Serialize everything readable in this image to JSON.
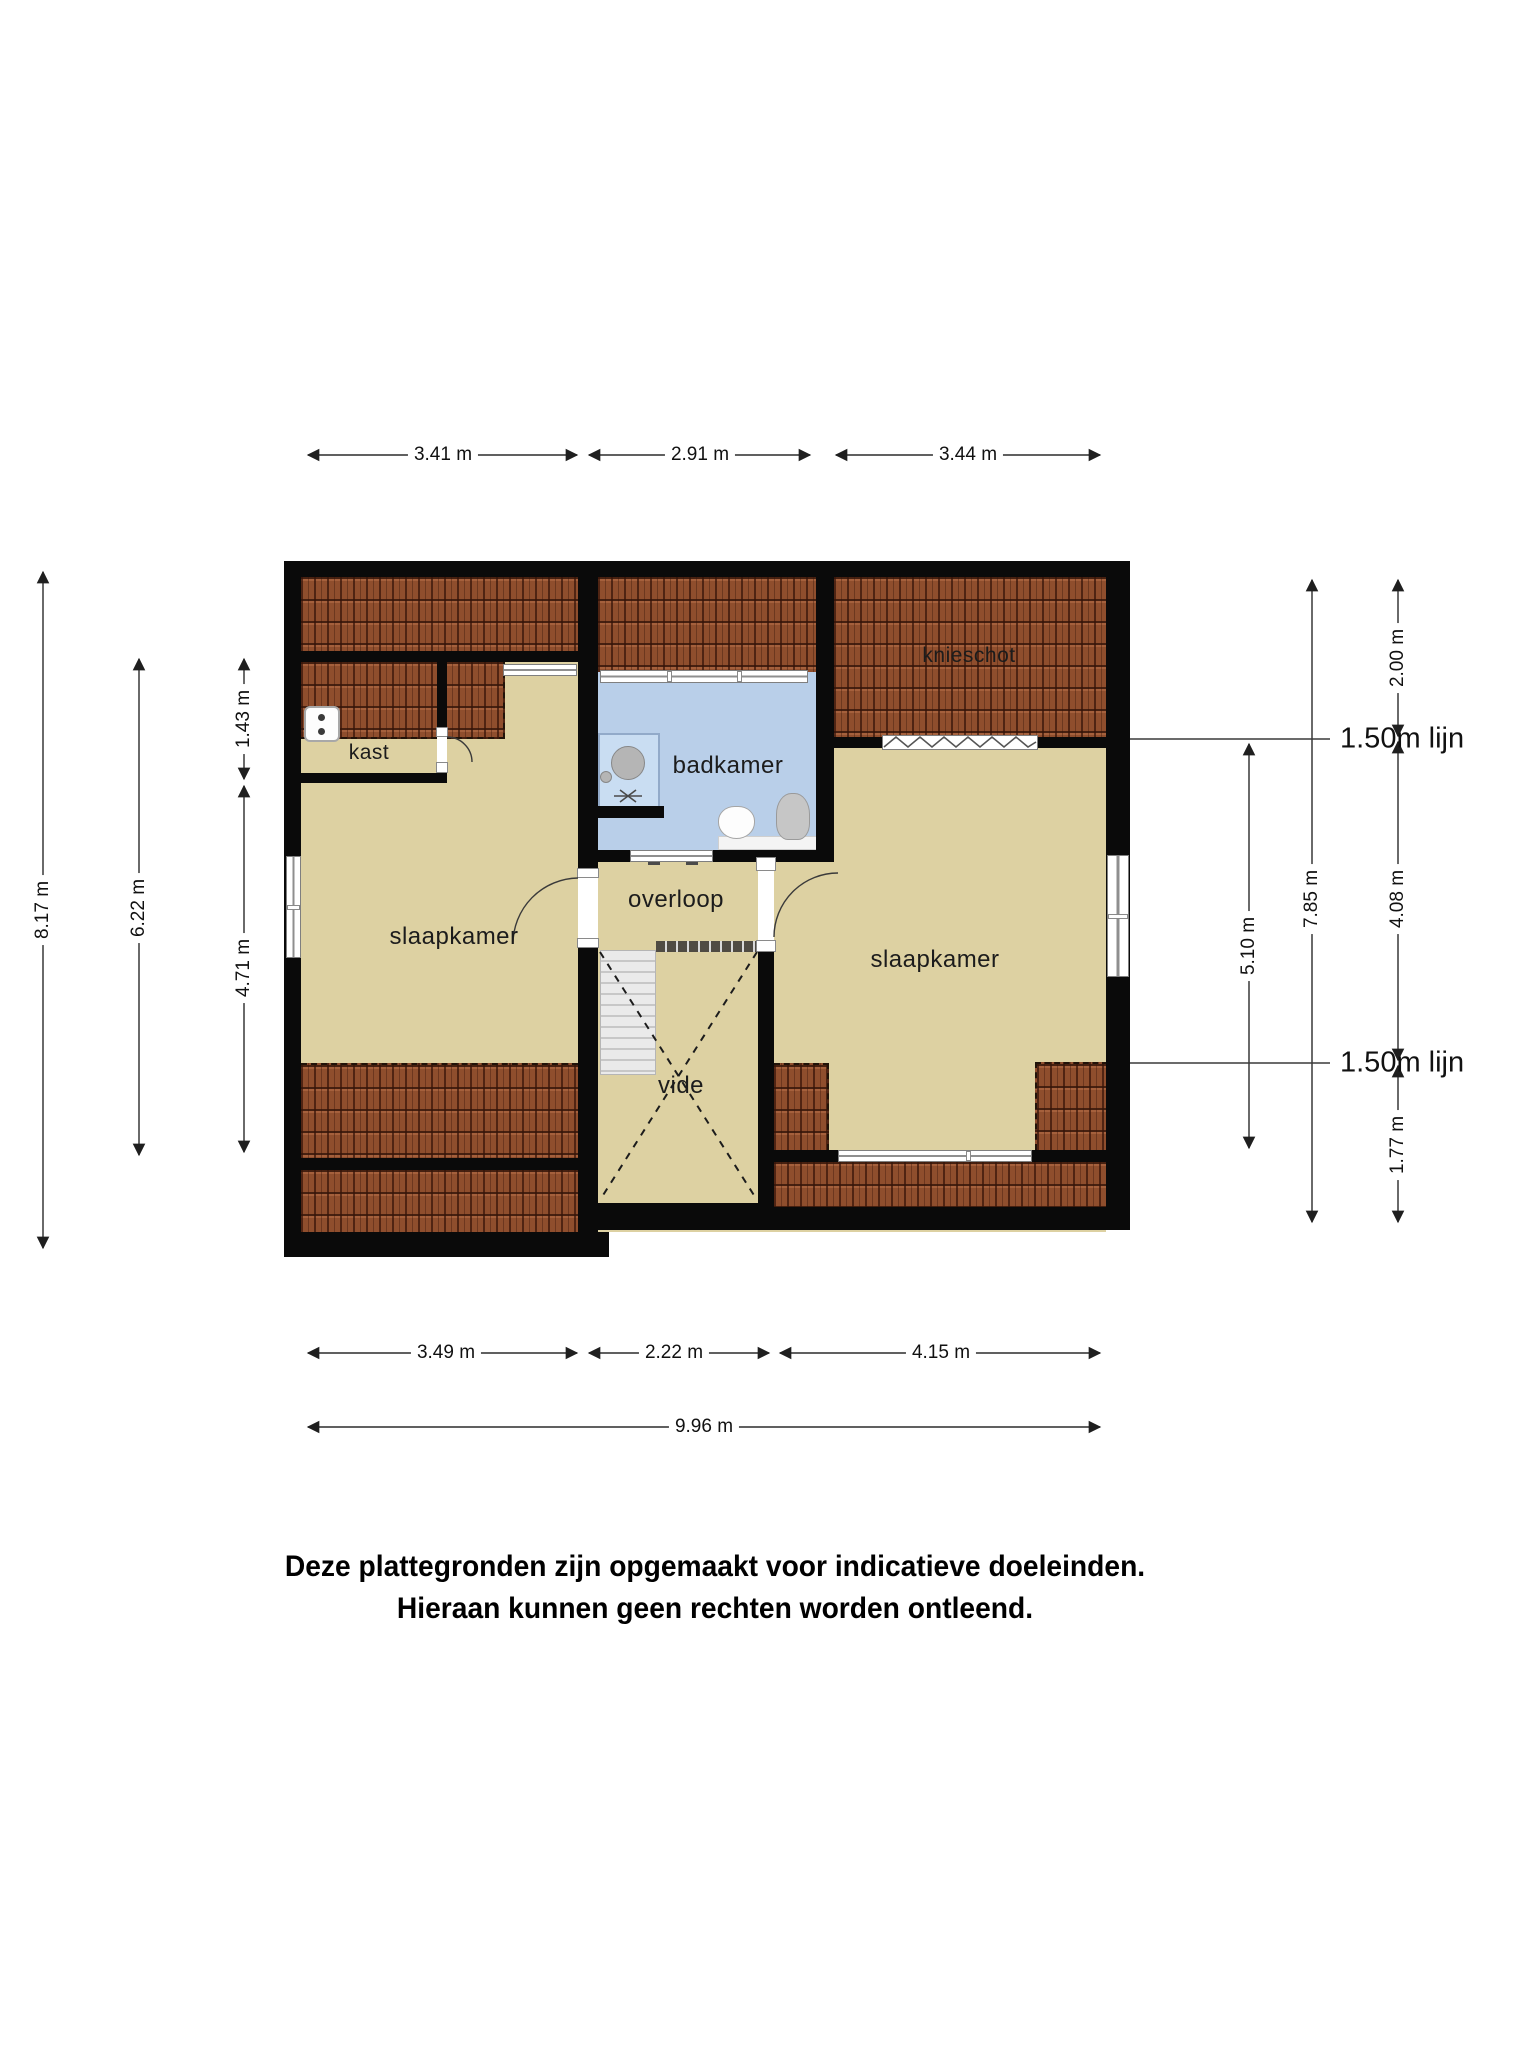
{
  "floorplan": {
    "rooms": {
      "kast": "kast",
      "slaapkamer_left": "slaapkamer",
      "badkamer": "badkamer",
      "overloop": "overloop",
      "vide": "vide",
      "slaapkamer_right": "slaapkamer",
      "knieschot": "knieschot"
    },
    "dimensions": {
      "top": [
        "3.41 m",
        "2.91 m",
        "3.44 m"
      ],
      "bottom": [
        "3.49 m",
        "2.22 m",
        "4.15 m"
      ],
      "bottom_total": "9.96 m",
      "left": [
        "8.17 m",
        "6.22 m",
        "1.43 m",
        "4.71 m"
      ],
      "right": [
        "5.10 m",
        "7.85 m",
        "2.00 m",
        "4.08 m",
        "1.77 m"
      ],
      "height_lines": [
        "1.50m lijn",
        "1.50m lijn"
      ]
    },
    "fixtures": [
      "boiler-icon",
      "shower-icon",
      "sink-icon",
      "toilet-icon",
      "radiator-icon",
      "stairs-icon",
      "railing-icon"
    ],
    "colors": {
      "wall": "#0a0a0a",
      "floor": "#ddd1a2",
      "roof_tiles": "#8f4e2d",
      "bathroom": "#b9cfe9",
      "stairs": "#dedede"
    },
    "disclaimer": {
      "line1": "Deze plattegronden zijn opgemaakt voor indicatieve doeleinden.",
      "line2": "Hieraan kunnen geen rechten worden ontleend."
    }
  }
}
